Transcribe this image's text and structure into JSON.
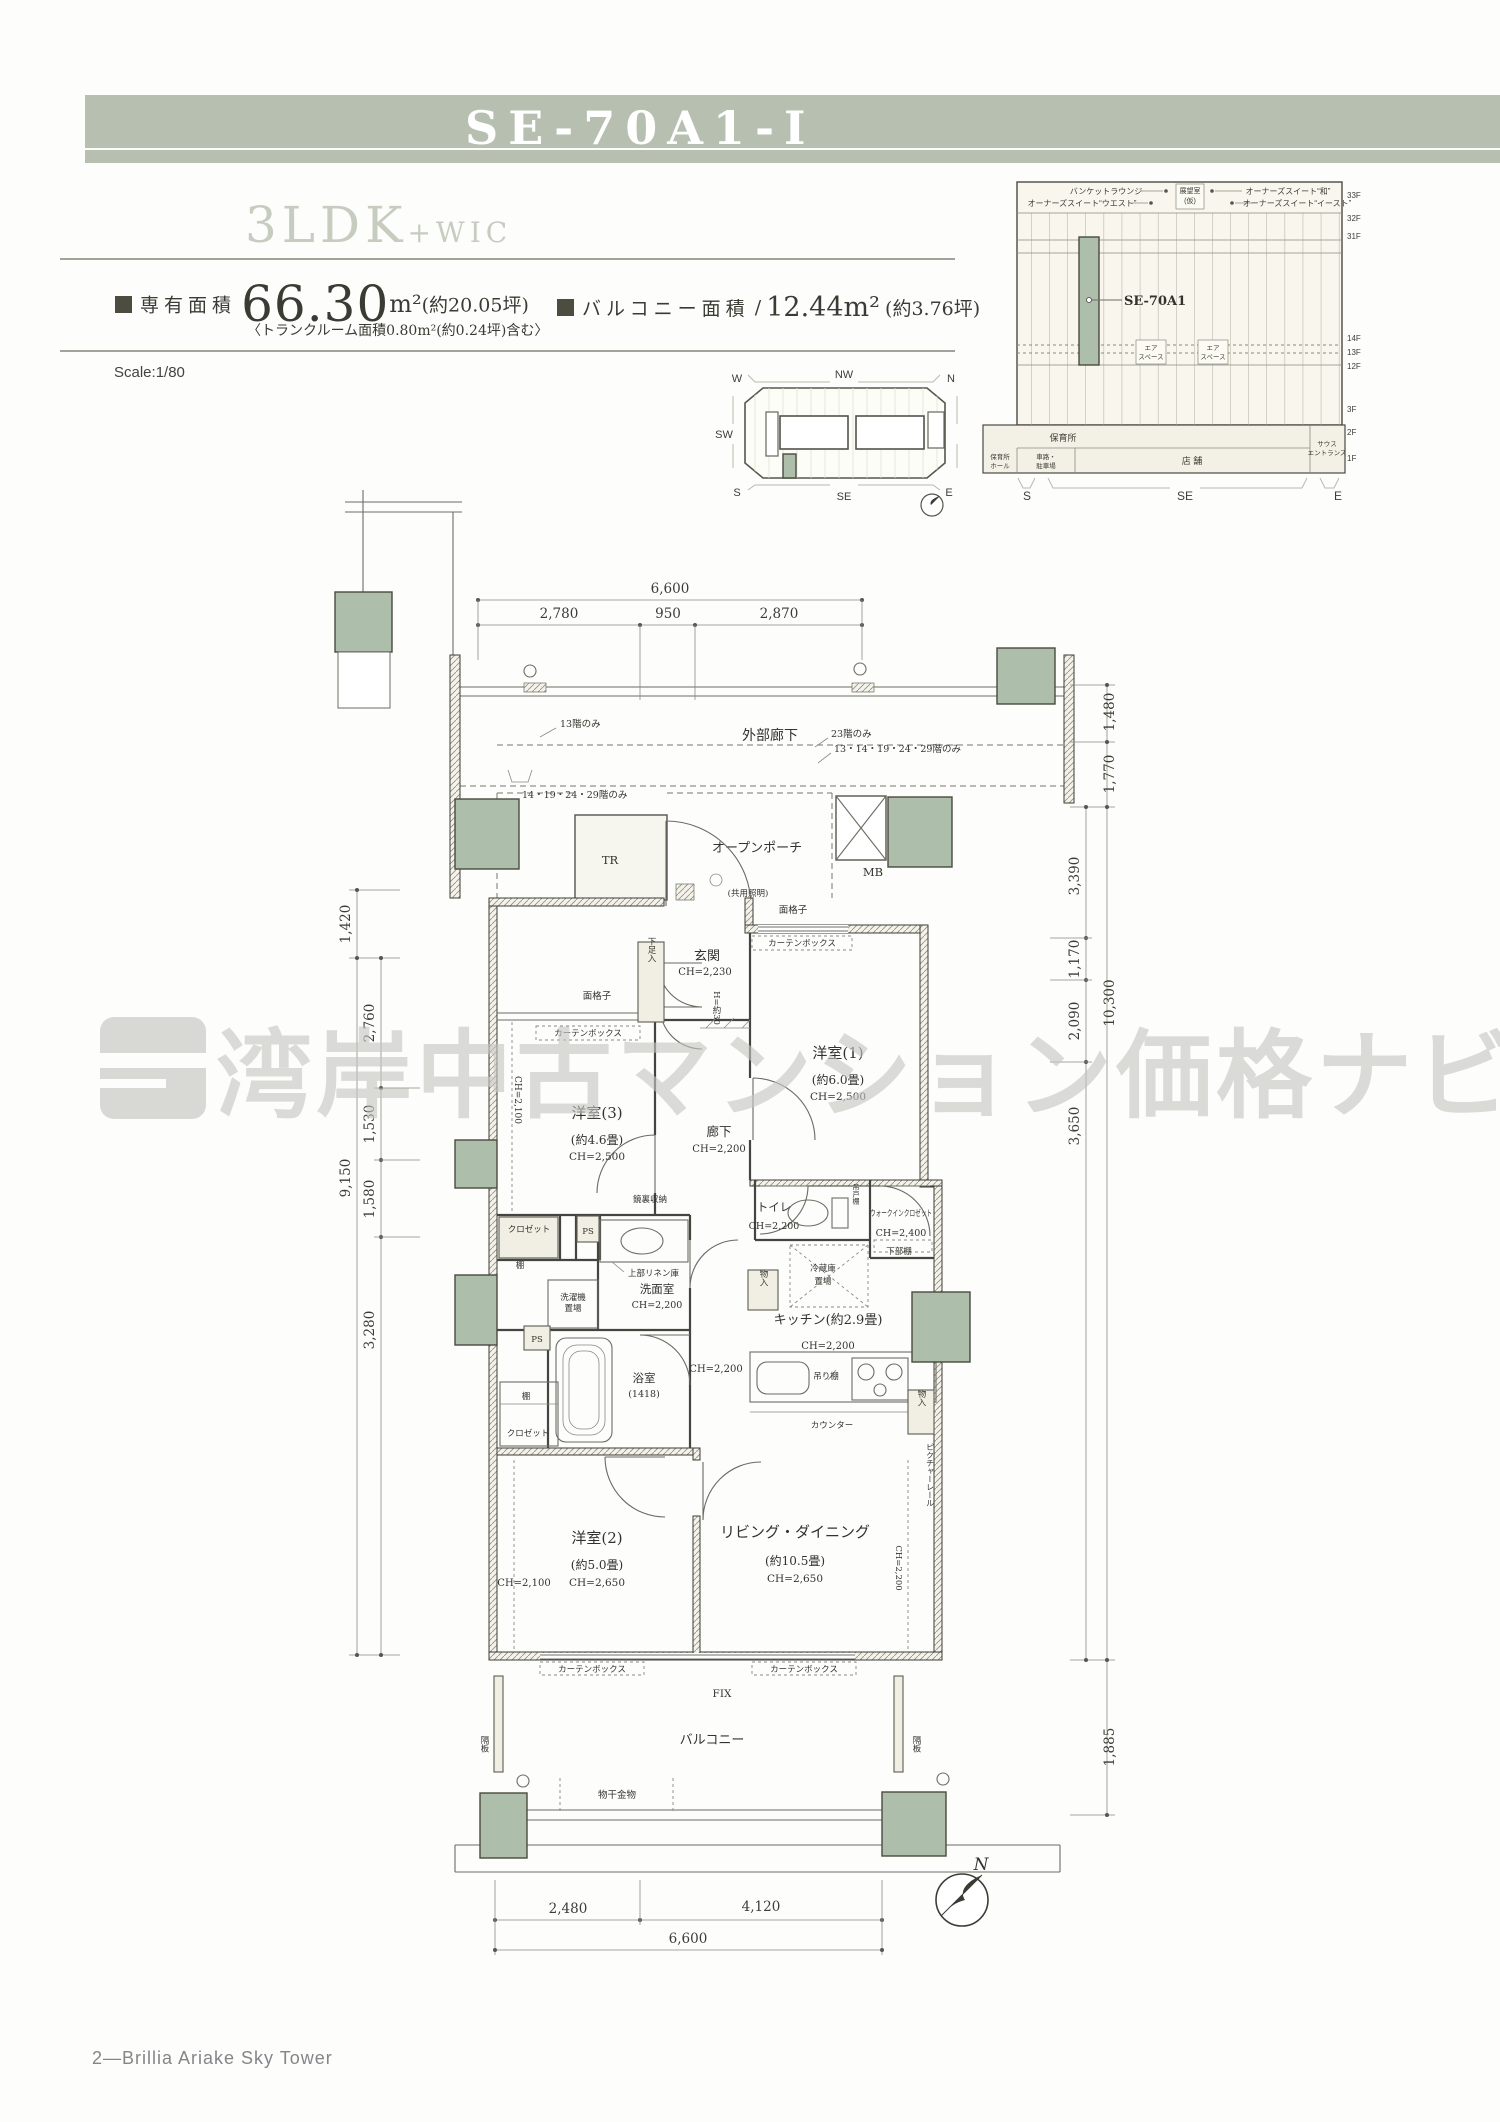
{
  "page": {
    "unit_code": "SE-70A1-Ⅰ",
    "plan_type": "3LDK",
    "plan_suffix": "+WIC",
    "scale": "Scale:1/80",
    "footer": "2—Brillia Ariake Sky Tower",
    "watermark": "湾岸中古マンション価格ナビ"
  },
  "area": {
    "exclusive_label": "専有面積",
    "exclusive_value": "66.30",
    "exclusive_unit": "m²",
    "exclusive_tsubo": "(約20.05坪)",
    "trunk_note": "〈トランクルーム面積0.80m²(約0.24坪)含む〉",
    "balcony_label": "バルコニー面積",
    "balcony_slash": "/",
    "balcony_value": "12.44m²",
    "balcony_tsubo": "(約3.76坪)"
  },
  "elevation": {
    "banquet": "バンケットラウンジ",
    "suite_west": "オーナーズスイート“ウエスト”",
    "observatory": "展望室",
    "observatory_note": "(仮)",
    "suite_wa": "オーナーズスイート“和”",
    "suite_east": "オーナーズスイート“イースト”",
    "unit": "SE-70A1",
    "air1": "エア",
    "air2": "スペース",
    "nursery": "保育所",
    "nursery_hall1": "保育所",
    "nursery_hall2": "ホール",
    "parking1": "車路・",
    "parking2": "駐車場",
    "shops": "店 舗",
    "entrance1": "サウス",
    "entrance2": "エントランス",
    "floors": [
      "33F",
      "32F",
      "31F",
      "14F",
      "13F",
      "12F",
      "3F",
      "2F",
      "1F"
    ],
    "dirs": [
      "S",
      "SE",
      "E"
    ]
  },
  "keyplan": {
    "dirs": [
      "W",
      "NW",
      "N",
      "SW",
      "S",
      "SE",
      "E"
    ]
  },
  "plan": {
    "corridor": "外部廊下",
    "notes": {
      "a": "13階のみ",
      "b": "23階のみ",
      "c": "13・14・19・24・29階のみ",
      "d": "14・19・24・29階のみ"
    },
    "porch": "オープンポーチ",
    "porch_note": "(共用照明)",
    "tr": "TR",
    "mb": "MB",
    "genkan": "玄関",
    "genkan_ch": "CH=2,230",
    "shoe": "下足入",
    "step": "H=約30",
    "lattice": "面格子",
    "curtain": "カーテンボックス",
    "rooms": {
      "b1": "洋室(1)",
      "b1_size": "(約6.0畳)",
      "b1_ch": "CH=2,500",
      "b2": "洋室(2)",
      "b2_size": "(約5.0畳)",
      "b2_ch": "CH=2,650",
      "b2_low": "CH=2,100",
      "b3": "洋室(3)",
      "b3_size": "(約4.6畳)",
      "b3_ch": "CH=2,500",
      "b3_low": "CH=2,100",
      "ld": "リビング・ダイニング",
      "ld_size": "(約10.5畳)",
      "ld_ch": "CH=2,650",
      "ld_low": "CH=2,200",
      "kitchen": "キッチン(約2.9畳)",
      "kitchen_ch": "CH=2,200",
      "hall": "廊下",
      "hall_ch": "CH=2,200",
      "hall2_ch": "CH=2,200",
      "toilet": "トイレ",
      "toilet_ch": "CH=2,200",
      "wash": "洗面室",
      "wash_ch": "CH=2,200",
      "bath": "浴室",
      "bath_size": "(1418)",
      "wic": "ウォークインクロゼット",
      "wic_ch": "CH=2,400",
      "wic_shelf": "下部棚"
    },
    "fix": {
      "closet": "クロゼット",
      "shelf": "棚",
      "ps": "PS",
      "washer1": "洗濯機",
      "washer2": "置場",
      "linen": "上部リネン庫",
      "mirror": "鏡裏収納",
      "storage": "物入",
      "fridge1": "冷蔵庫",
      "fridge2": "置場",
      "hang": "吊り棚",
      "toilet_shelf": "吊戸棚",
      "counter": "カウンター",
      "rail": "ピクチャーレール",
      "fixwin": "FIX",
      "balcony": "バルコニー",
      "partition": "隔板",
      "drying": "物干金物"
    },
    "dims": {
      "top_total": "6,600",
      "top": [
        "2,780",
        "950",
        "2,870"
      ],
      "left_upper": "1,420",
      "left_total": "9,150",
      "left": [
        "2,760",
        "1,530",
        "1,580",
        "3,280"
      ],
      "right_upper": "1,480",
      "right_mid": "1,770",
      "right_total": "10,300",
      "right": [
        "3,390",
        "1,170",
        "2,090",
        "3,650"
      ],
      "right_low": "1,885",
      "bottom": [
        "2,480",
        "4,120"
      ],
      "bottom_total": "6,600"
    },
    "compass": "N"
  }
}
